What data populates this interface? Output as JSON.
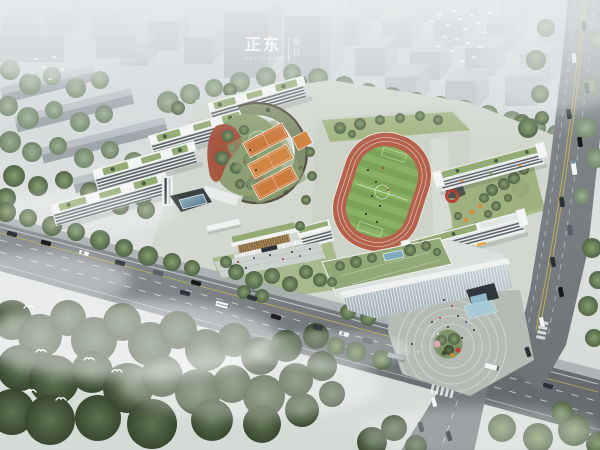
{
  "watermark": {
    "brand": "正东",
    "subtitle": "EST VISION",
    "side_chars": [
      "视",
      "觉"
    ]
  },
  "scene": {
    "type": "aerial-architectural-rendering",
    "subject": "Bird's-eye rendering of a school campus: stepped white teaching buildings with green roofs around a curved corridor and garden courtyard, orange sports courts, a red running track with striped green field, a glass gymnasium, tree-lined roads with traffic, dense misty forest in the foreground and gray high-rise blocks fading into fog behind",
    "labels": {
      "city-skyline": "gray high-rise blocks in fog",
      "tree-belt": "tree belt behind campus",
      "teaching-buildings": "stepped white teaching slabs with green roofs",
      "arc-corridor": "curved connecting corridor building",
      "central-courtyard": "landscaped inner courtyard with red paths",
      "sports-courts": "orange ball courts",
      "running-track": "red running track",
      "football-field": "striped green football field",
      "east-cluster": "east classroom cluster with play courtyard",
      "roof-garden": "roof garden terrace with pool skylight",
      "gymnasium": "glass-faced gymnasium with waterfall entry",
      "entrance-gate": "timber-louvre entrance gate",
      "main-road": "main avenue with cars and buses",
      "side-road": "north-south side road",
      "corner-plaza": "circular corner plaza with planted island",
      "forest": "dense foreground forest",
      "mist": "low drifting mist",
      "birds": "bird flocks"
    }
  },
  "palette": {
    "fog": "#ccd3d8",
    "city_block": "#a7afb5",
    "tree_dark": "#42523a",
    "tree_light": "#869c6c",
    "road": "#73797d",
    "lane_yellow": "#cdbd4e",
    "track_red": "#b4624c",
    "field_green": "#7ca257",
    "building_white": "#eceeed",
    "green_roof": "#93ac74",
    "court_orange": "#cd7c40",
    "courtyard_red": "#a5523e",
    "water_blue": "#8fb9cc"
  }
}
